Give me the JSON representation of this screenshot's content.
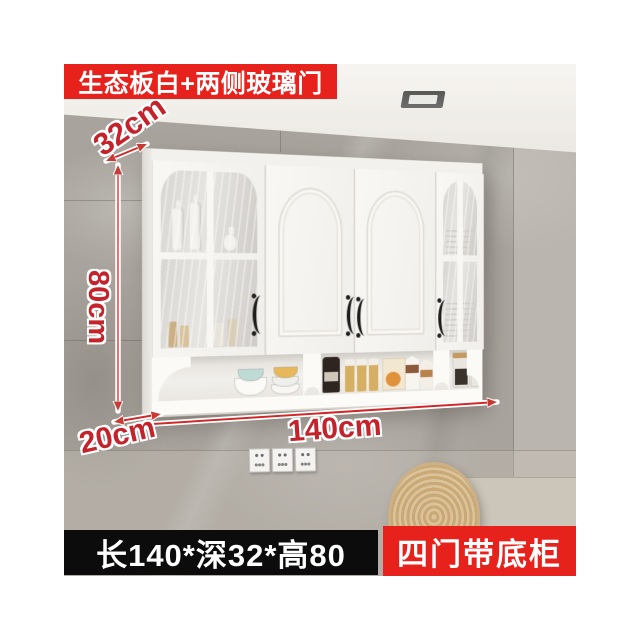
{
  "product_image": {
    "badge_top": "生态板白+两侧玻璃门",
    "badge_bottom_right": "四门带底柜",
    "size_bar_text": "长140*深32*高80",
    "dimensions": {
      "depth_top": "32cm",
      "height": "80cm",
      "depth_bottom": "20cm",
      "width": "140cm"
    },
    "colors": {
      "badge_red": "#e7211c",
      "dimension_red": "#c4232b",
      "size_bar_black": "#0c0c0c",
      "wall_gray": "#a8a39c",
      "cabinet_white": "#f6f5f1"
    }
  }
}
